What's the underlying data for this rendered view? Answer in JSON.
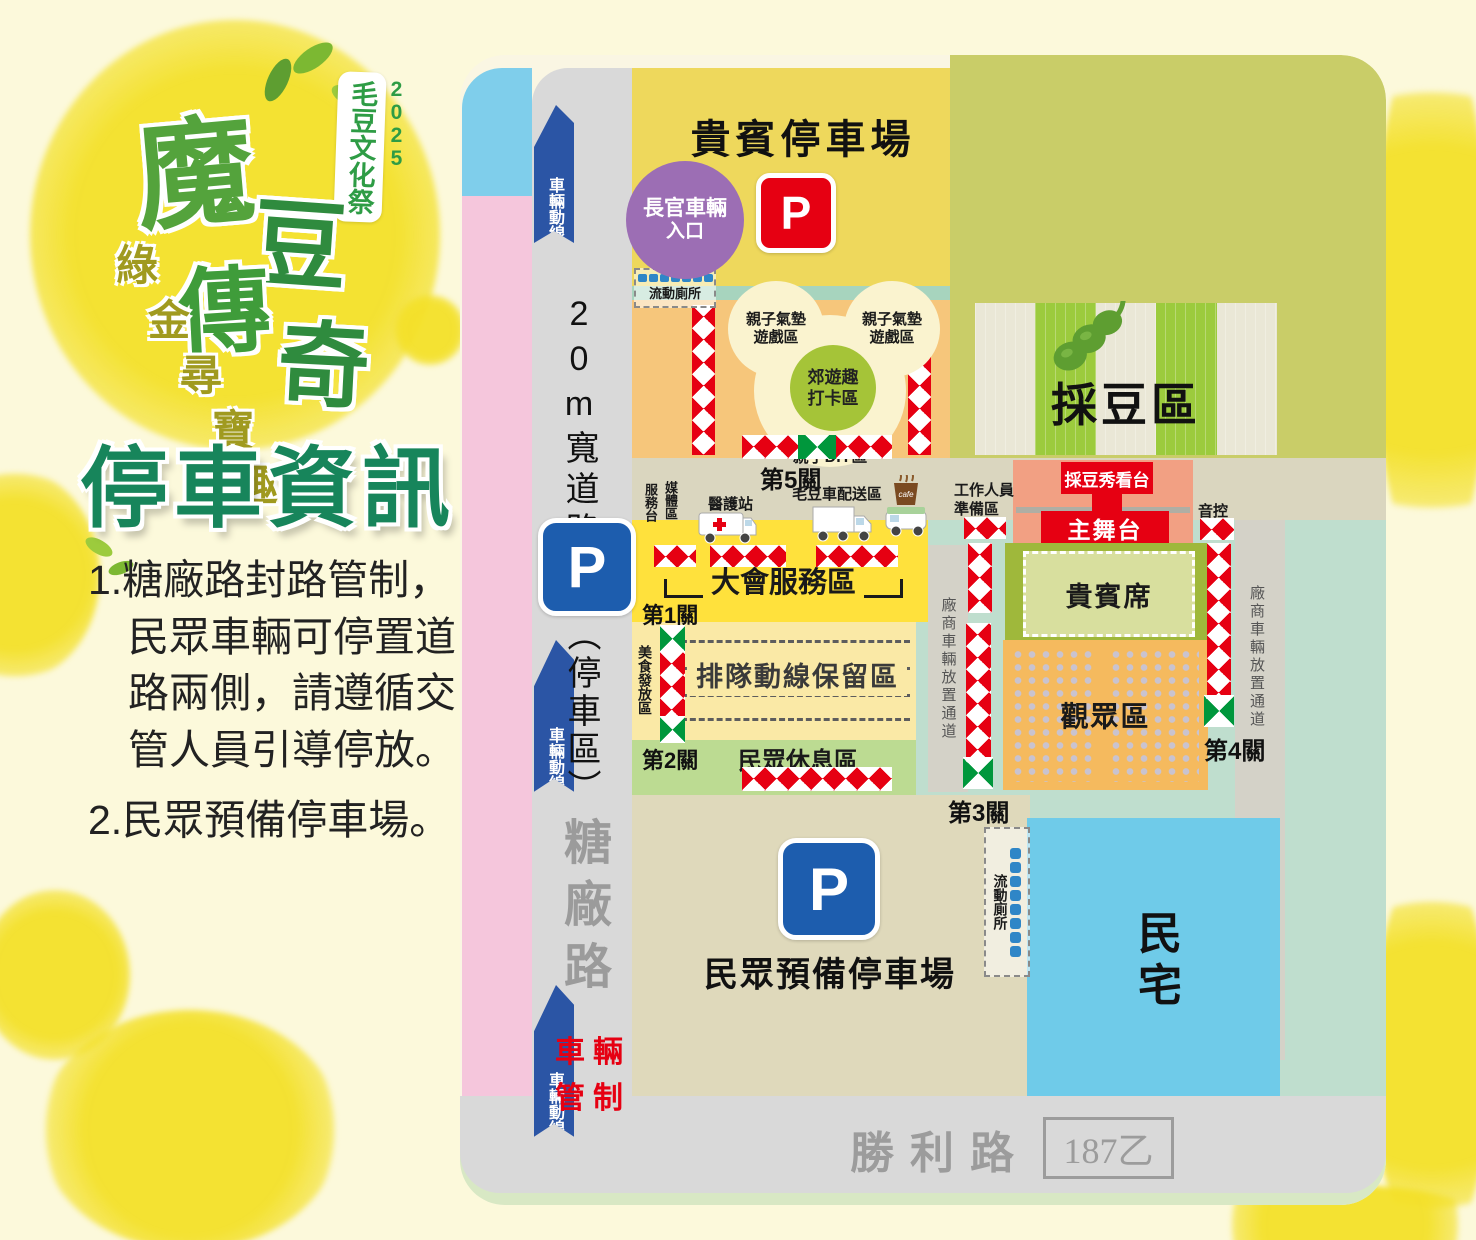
{
  "colors": {
    "accent_red": "#E60012",
    "parking_blue": "#1D5DAE",
    "entrance_purple": "#9C6EB4",
    "map_teal": "#BFDECE",
    "road_gray": "#D9D9D9",
    "title_green": "#17855B"
  },
  "logo": {
    "year": "2025",
    "festival": "毛豆文化祭",
    "title_chars": [
      "魔",
      "豆",
      "傳",
      "奇"
    ],
    "tagline_chars": [
      "綠",
      "金",
      "尋",
      "寶",
      "趣"
    ],
    "heading": "停車資訊"
  },
  "notes": {
    "item1_lines": [
      "1.糖廠路封路管制，",
      "民眾車輛可停置道",
      "路兩側，請遵循交",
      "管人員引導停放。"
    ],
    "item2": "2.民眾預備停車場。"
  },
  "roads": {
    "wide_road": "20m寬道路",
    "parking_zone": "（停車區）",
    "sugar_road": "糖廠路",
    "victory_road": "勝利路",
    "route_no": "187乙",
    "flow": "車輛動線",
    "control_chars": [
      "車",
      "輛",
      "管",
      "制"
    ],
    "p": "P"
  },
  "gates": [
    "第1關",
    "第2關",
    "第3關",
    "第4關",
    "第5關"
  ],
  "areas": {
    "vip_lot": "貴賓停車場",
    "officials_l1": "長官車輛",
    "officials_l2": "入口",
    "toilet": "流動廁所",
    "bounce_l1": "親子氣墊",
    "bounce_l2": "遊戲區",
    "photo_l1": "郊遊趣",
    "photo_l2": "打卡區",
    "diy": "親子DIY區",
    "bean_zone": "採豆區",
    "service_desk": "服務台",
    "media": "媒體區",
    "medical": "醫護站",
    "edamame_truck": "毛豆車配送區",
    "cafe": "cafe",
    "event_service": "大會服務區",
    "food": "美食發放區",
    "queue": "排隊動線保留區",
    "rest": "民眾休息區",
    "staff_l1": "工作人員",
    "staff_l2": "準備區",
    "show_stand": "採豆秀看台",
    "stage": "主舞台",
    "sound": "音控",
    "vip_seats": "貴賓席",
    "audience": "觀眾區",
    "vendor_lane": "廠商車輛放置通道",
    "public_lot": "民眾預備停車場",
    "houses": "民宅"
  }
}
